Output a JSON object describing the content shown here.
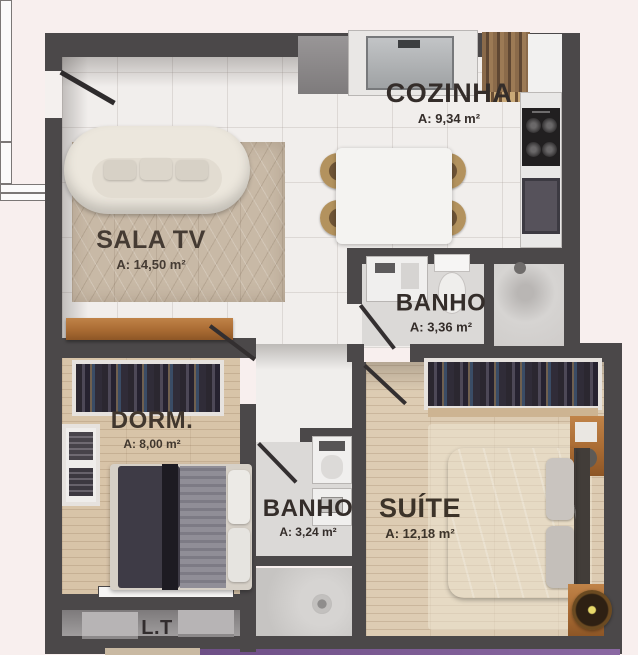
{
  "title": "apartment-floor-plan",
  "rooms": {
    "sala_tv": {
      "name": "SALA TV",
      "area": "A: 14,50 m²"
    },
    "cozinha": {
      "name": "COZINHA",
      "area": "A: 9,34 m²"
    },
    "banho_social": {
      "name": "BANHO",
      "area": "A: 3,36 m²"
    },
    "dorm": {
      "name": "DORM.",
      "area": "A: 8,00 m²"
    },
    "banho_suite": {
      "name": "BANHO",
      "area": "A: 3,24 m²"
    },
    "suite": {
      "name": "SUÍTE",
      "area": "A: 12,18 m²"
    },
    "laundry_terrace": {
      "name": "L.T"
    }
  },
  "colors": {
    "background": "#f8efee",
    "walls": "#4b4849",
    "wood_floor": "#d8c4a8",
    "rug": "#c8b9a6",
    "furniture_wood": "#a96b33",
    "accent_purple": "#6e4f86",
    "accent_tan": "#c9b9a2",
    "label_text": "#342d2a"
  }
}
